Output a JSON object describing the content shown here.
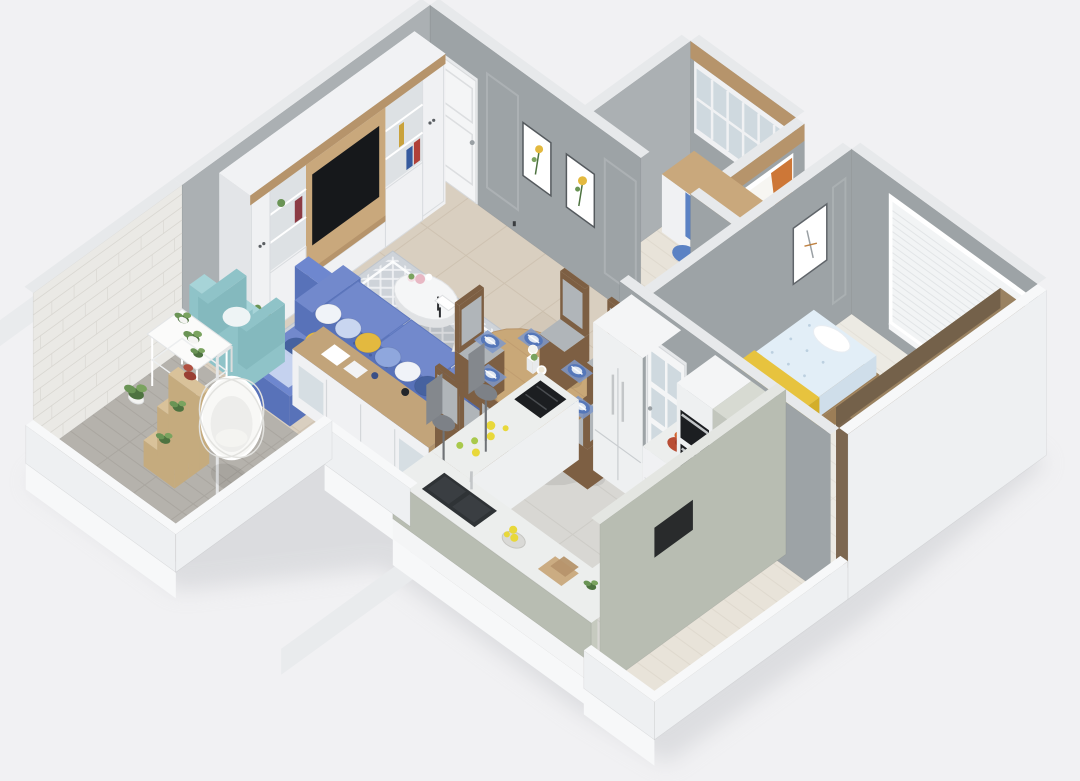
{
  "scene": {
    "description": "3D isometric cutaway floor plan rendering of an apartment, viewed from above",
    "rooms": [
      {
        "name": "living-room",
        "floor": "beige-tile",
        "furniture": [
          "tv-wall-cabinet",
          "tv",
          "blue-tufted-sofa",
          "throw-pillows",
          "round-coffee-table",
          "teal-armchair",
          "gold-side-table",
          "sideboard",
          "lattice-rug",
          "floor-lamp"
        ]
      },
      {
        "name": "dining-area",
        "floor": "beige-tile",
        "furniture": [
          "oval-wood-dining-table",
          "dining-chairs-x6",
          "blue-striped-place-settings",
          "white-flower-centerpieces"
        ]
      },
      {
        "name": "kitchen",
        "floor": "gray-tile",
        "furniture": [
          "refrigerator",
          "double-wall-oven",
          "fruit-bowl",
          "open-shelf-unit",
          "cooktop-counter",
          "sink-counter",
          "lemon-basket",
          "cutting-boards",
          "peninsula-counter",
          "bar-stools-x2"
        ]
      },
      {
        "name": "study-nook",
        "floor": "cream-herringbone-wood",
        "furniture": [
          "built-in-desk",
          "glass-upper-cabinets",
          "blue-office-chair",
          "window-with-orange-curtains",
          "yellow-flowers"
        ]
      },
      {
        "name": "bedroom",
        "floor": "white-herringbone-wood",
        "furniture": [
          "bed",
          "yellow-throw-blanket",
          "white-pillow",
          "wall-art",
          "window-with-blinds",
          "brown-wardrobe",
          "wood-bench",
          "vase-with-branches",
          "glazed-white-door"
        ]
      },
      {
        "name": "balcony",
        "floor": "gray-herringbone-wood",
        "furniture": [
          "white-brick-wall",
          "hanging-egg-chair",
          "ladder-plant-shelf",
          "white-plant-stand",
          "potted-plants"
        ]
      },
      {
        "name": "entry-hall",
        "floor": "beige-tile",
        "furniture": [
          "white-front-door",
          "framed-botanical-print-1",
          "framed-botanical-print-2"
        ]
      },
      {
        "name": "hallway",
        "floor": "cream-herringbone-wood",
        "furniture": []
      }
    ],
    "palette": {
      "bg": "#f1f1f3",
      "shadow": "#c7c9cd",
      "slab": "#f7f8f9",
      "slabSide": "#e9ebed",
      "wallGray": "#9da3a6",
      "wallGrayLight": "#abb0b3",
      "wallTop": "#e7e9eb",
      "wallWhite": "#eef0f2",
      "whiteTop": "#f7f8f9",
      "brick": "#eae9e5",
      "brickLine": "#d7d5cf",
      "floorBeige": "#d9cfc0",
      "beigeLine": "#c6b9a6",
      "floorKitchen": "#d8d7d3",
      "kitchenLine": "#c7c5c0",
      "herrCream": "#e8e3d9",
      "herrCreamLine": "#d6d0c4",
      "herrGray": "#b5b2ac",
      "herrGrayLine": "#a19d97",
      "herrWhite": "#eceae3",
      "herrWhiteLine": "#dbd7cf",
      "cabWhite": "#f0f1f3",
      "cabRecess": "#dde1e4",
      "wood": "#b6946b",
      "woodLight": "#c9a87c",
      "tvBlack": "#16181b",
      "sofaBlue": "#6e87cf",
      "sofaDark": "#5872b9",
      "seatBlue": "#7289cc",
      "pillowWhite": "#f0f3f8",
      "pillowLightBlue": "#c9d6f0",
      "pillowYellow": "#e3b93f",
      "pillowBlue": "#8fa7dd",
      "pillowNavy": "#46629f",
      "teal": "#a7d4d8",
      "tealDark": "#8fc3c8",
      "rugBase": "#ced3d9",
      "rugLattice": "#f2f3f5",
      "gold": "#b2913e",
      "goldDark": "#9a7c33",
      "tableWood": "#c9a878",
      "tableEdge": "#ad8759",
      "chairWood": "#7d5f43",
      "chairSeat": "#b0b5b9",
      "plate": "#5577b9",
      "plateLight": "#dfe7f2",
      "napkin": "#7e98c9",
      "sideboardWood": "#c2a47a",
      "sage": "#b8bdb2",
      "sageLight": "#e4e6e2",
      "counterTop": "#eceeed",
      "counterFront": "#c6cabf",
      "applianceWhite": "#eef0f1",
      "black": "#1c1e21",
      "steel": "#c3c6c8",
      "lemon": "#e8d83a",
      "lime": "#a9c94c",
      "redBowl": "#b84d35",
      "mattress": "#e2eef7",
      "mattressLine": "#bcd0e0",
      "blanket": "#e7c33e",
      "blanketDark": "#d3ae2a",
      "bedWood": "#9c7e57",
      "blinds": "#f2f4f5",
      "blindsLine": "#dfe2e4",
      "curtain": "#cd7737",
      "sheer": "#f7f6f2",
      "wardrobe": "#8d7557",
      "wardrobeTop": "#9a8261",
      "wardrobeEnd": "#7c6750",
      "wardrobeBand": "#74614a",
      "doorWhite": "#f4f5f6",
      "glass": "#cfd9df",
      "green": "#6a9455",
      "greenDark": "#4e7340",
      "greenLight": "#7aa35f",
      "redLeaf": "#9a4034",
      "potWhite": "#f4f4f2",
      "chairBlue": "#5b82c4",
      "metal": "#8a8f93",
      "white": "#ffffff"
    }
  }
}
